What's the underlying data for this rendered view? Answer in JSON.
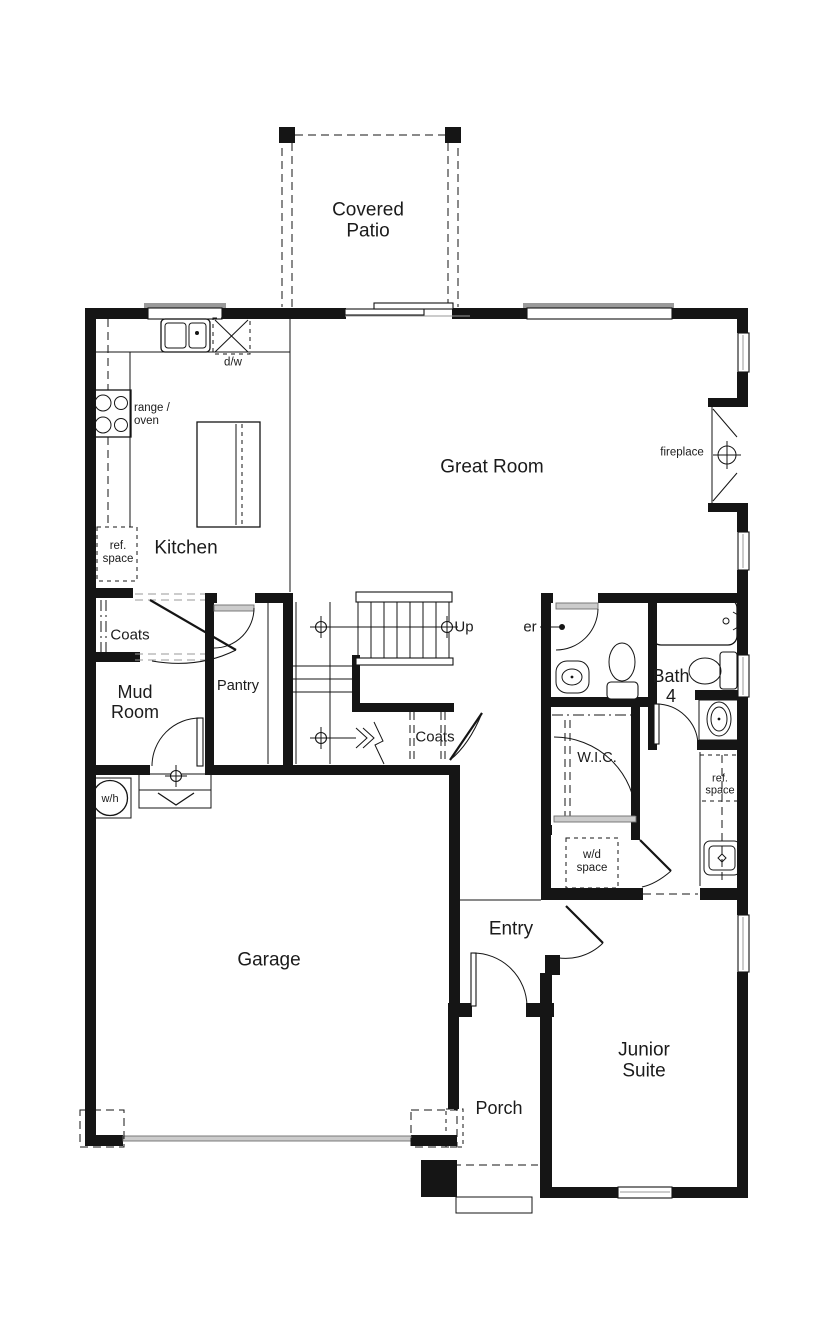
{
  "colors": {
    "line": "#151515",
    "gray": "#9a9a9a",
    "door_leaf": "#cccccc",
    "background": "#ffffff"
  },
  "labels": {
    "covered_patio": {
      "lines": [
        "Covered",
        "Patio"
      ]
    },
    "great_room": {
      "lines": [
        "Great Room"
      ]
    },
    "fireplace": {
      "lines": [
        "fireplace"
      ]
    },
    "kitchen": {
      "lines": [
        "Kitchen"
      ]
    },
    "dishwasher": {
      "lines": [
        "d/w"
      ]
    },
    "range_oven": {
      "lines": [
        "range /",
        "oven"
      ]
    },
    "ref_space_kitchen": {
      "lines": [
        "ref.",
        "space"
      ]
    },
    "coats_mud": {
      "lines": [
        "Coats"
      ]
    },
    "mud_room": {
      "lines": [
        "Mud",
        "Room"
      ]
    },
    "pantry": {
      "lines": [
        "Pantry"
      ]
    },
    "stairs_up": {
      "lines": [
        "Up"
      ]
    },
    "powder_partial": {
      "lines": [
        "er"
      ]
    },
    "coats_stair": {
      "lines": [
        "Coats"
      ]
    },
    "bath_4": {
      "lines": [
        "Bath",
        "4"
      ]
    },
    "wic": {
      "lines": [
        "W.I.C."
      ]
    },
    "ref_space_hall": {
      "lines": [
        "ref.",
        "space"
      ]
    },
    "wd_space": {
      "lines": [
        "w/d",
        "space"
      ]
    },
    "water_heater": {
      "lines": [
        "w/h"
      ]
    },
    "garage": {
      "lines": [
        "Garage"
      ]
    },
    "entry": {
      "lines": [
        "Entry"
      ]
    },
    "junior_suite": {
      "lines": [
        "Junior",
        "Suite"
      ]
    },
    "porch": {
      "lines": [
        "Porch"
      ]
    }
  }
}
